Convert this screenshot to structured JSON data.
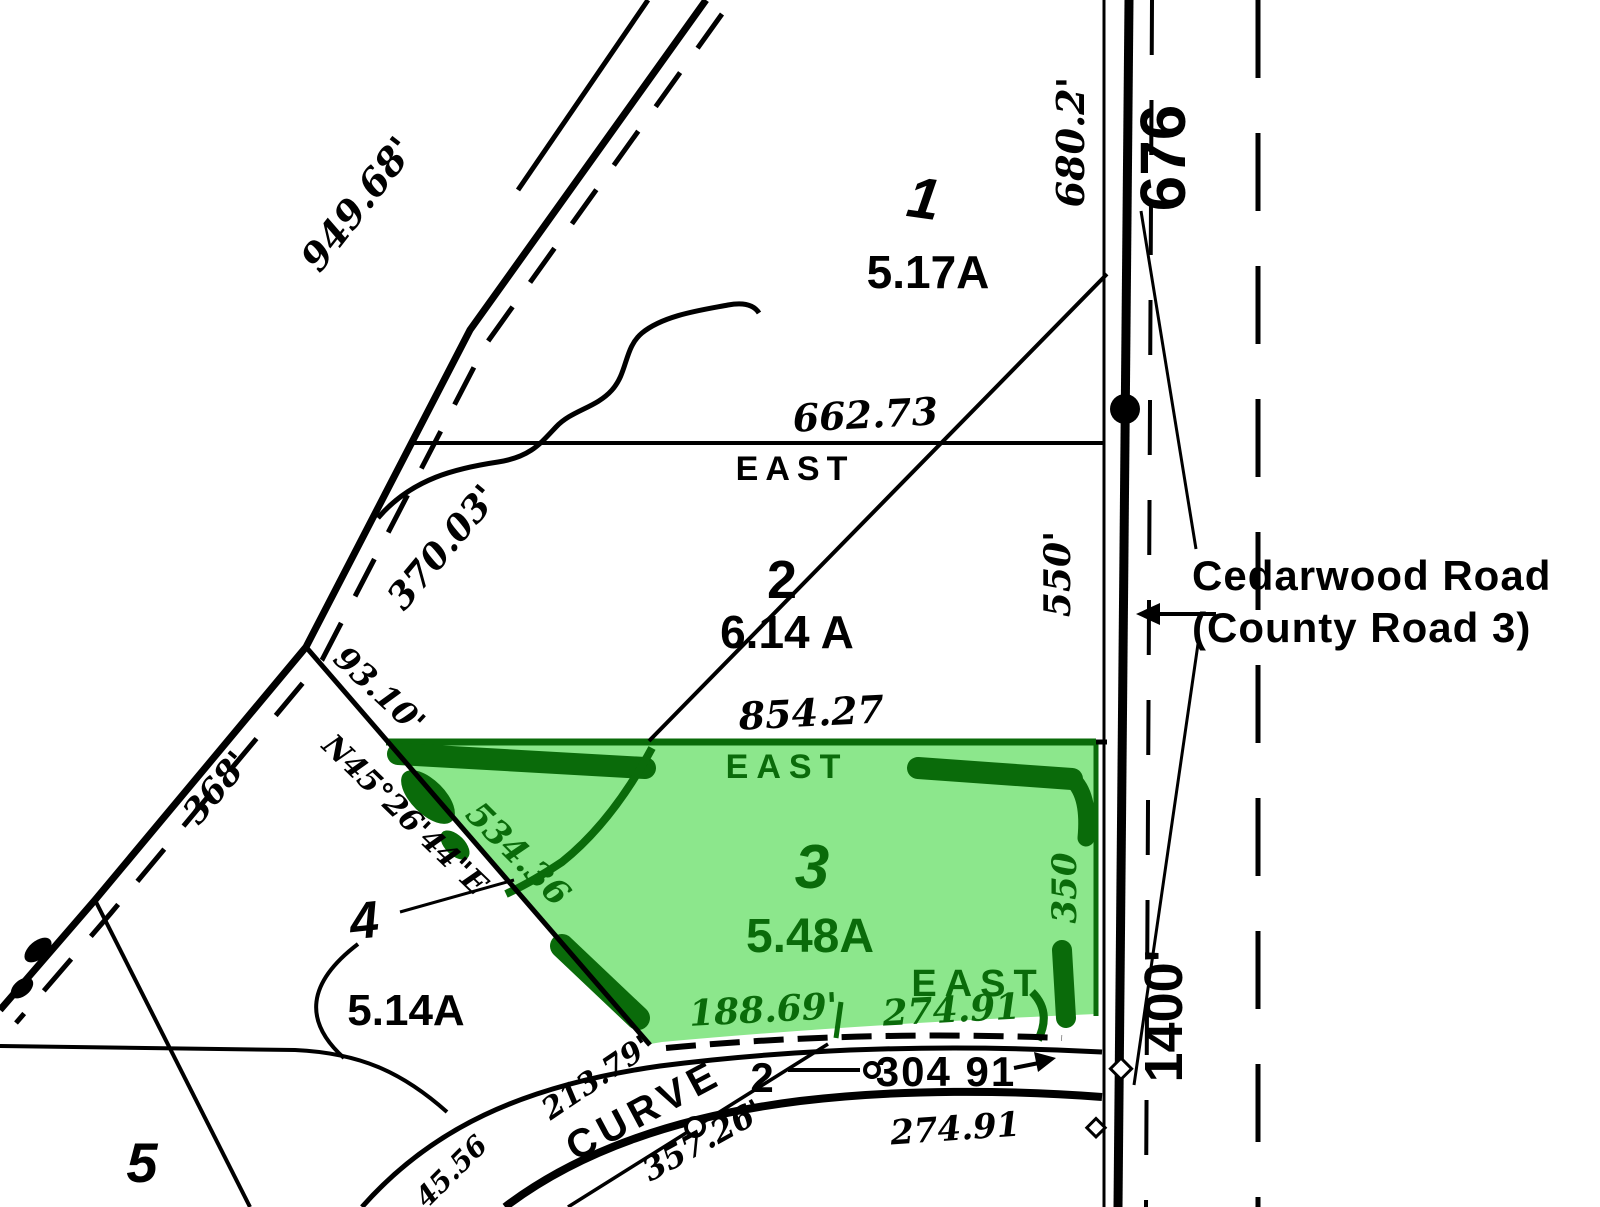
{
  "colors": {
    "paper": "#FFFFFF",
    "ink": "#000000",
    "highlight_fill": "#8CE78C",
    "highlight_ink": "#0A6B0A"
  },
  "callout": {
    "road_name": "Cedarwood Road",
    "road_name_2": "(County Road 3)"
  },
  "route_markers": {
    "north": "676",
    "south": "1400'"
  },
  "parcels": {
    "p1": {
      "number": "1",
      "area": "5.17A"
    },
    "p2": {
      "number": "2",
      "area": "6.14 A"
    },
    "p3": {
      "number": "3",
      "area": "5.48A"
    },
    "p4": {
      "number": "4",
      "area": "5.14A"
    },
    "p5": {
      "number": "5"
    }
  },
  "direction_labels": {
    "parcel1_south_line": "EAST",
    "parcel3_north_line": "EAST",
    "parcel3_south_line": "EAST"
  },
  "dimensions": {
    "road_frontage_p1": "680.2'",
    "road_frontage_p2": "550'",
    "road_frontage_p3": "350",
    "p1_south_line": "662.73",
    "p3_north_line": "854.27",
    "nw_road_upper": "949.68'",
    "nw_road_mid": "370.03'",
    "nw_road_lower": "368'",
    "sw_boundary_road_tie": "93.10'",
    "sw_boundary_bearing": "N45°26'44\"E",
    "sw_boundary_length": "534.36",
    "p3_south_west": "188.69'",
    "p3_south_east": "274.91",
    "street_dimension": "304 91",
    "street_dimension_below": "274.91",
    "curve_tie": "213.79'",
    "curve_length": "357.26'",
    "curve_short": "45.56"
  },
  "curve_label": {
    "word": "CURVE",
    "number": "2"
  }
}
